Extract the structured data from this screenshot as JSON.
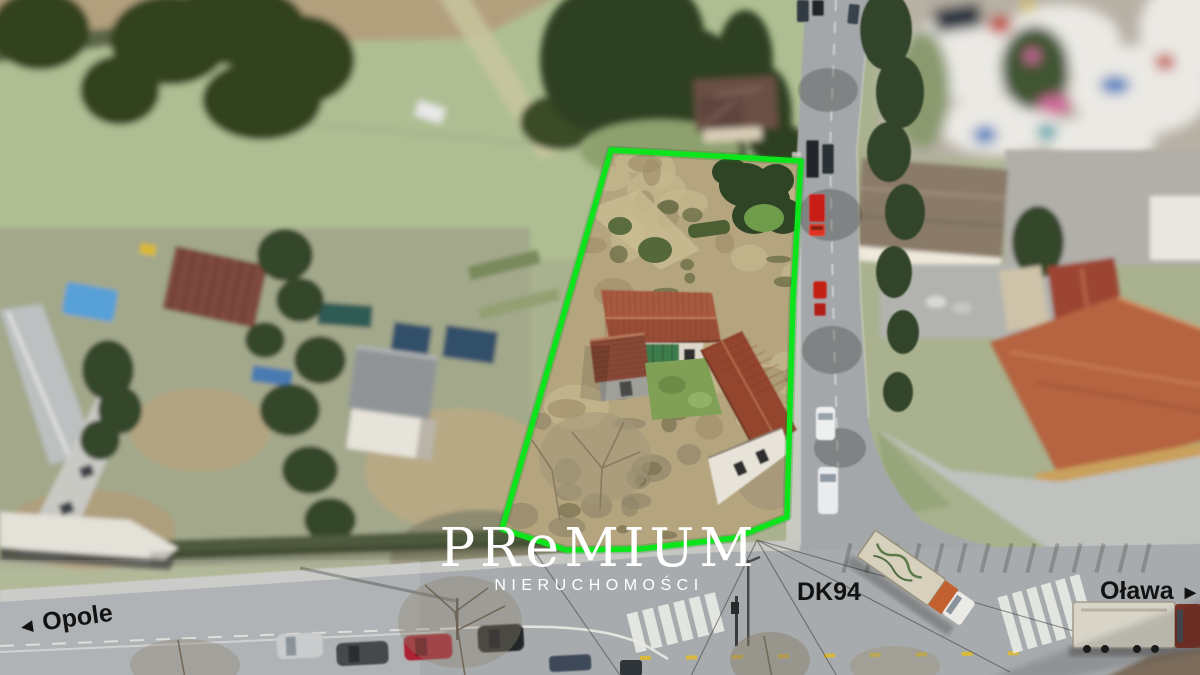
{
  "photo": {
    "kind": "drone aerial photo of property listing",
    "plot_boundary_color": "#0ce51c"
  },
  "watermark": {
    "brand_start": "PR",
    "brand_e": "e",
    "brand_end": "MIUM",
    "subtitle": "NIERUCHOMOŚCI",
    "color": "#ffffff"
  },
  "labels": {
    "left_direction": {
      "arrow": "◄",
      "text": "Opole"
    },
    "route": {
      "text": "DK94"
    },
    "right_direction": {
      "text": "Oława",
      "arrow": "►"
    },
    "color": "#121212"
  }
}
